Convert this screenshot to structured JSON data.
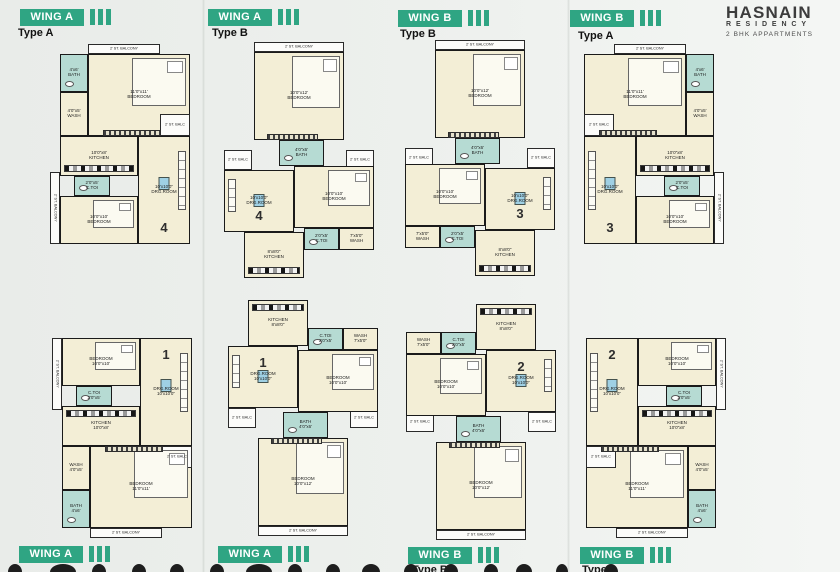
{
  "brand": {
    "name": "HASNAIN",
    "subname": "RESIDENCY",
    "tagline": "2 BHK  APPARTMENTS"
  },
  "colors": {
    "accent": "#2fa583",
    "room_cream": "#f3eed6",
    "wet_teal": "#b6dbd3",
    "wall": "#1a1a1a",
    "page_bg": "#edf0ed"
  },
  "headers_top": [
    {
      "wing": "WING A",
      "type_label": "Type A",
      "x": 20,
      "tx": 18,
      "y": 8,
      "ty": 27
    },
    {
      "wing": "WING A",
      "type_label": "Type B",
      "x": 208,
      "tx": 212,
      "y": 8,
      "ty": 27
    },
    {
      "wing": "WING B",
      "type_label": "Type B",
      "x": 398,
      "tx": 400,
      "y": 9,
      "ty": 28
    },
    {
      "wing": "WING B",
      "type_label": "Type A",
      "x": 570,
      "tx": 578,
      "y": 9,
      "ty": 30
    }
  ],
  "footers_bottom": [
    {
      "wing": "WING A",
      "x": 19,
      "y": 545
    },
    {
      "wing": "WING A",
      "x": 218,
      "y": 545
    },
    {
      "wing": "WING B",
      "x": 408,
      "y": 546
    },
    {
      "wing": "WING B",
      "x": 580,
      "y": 546
    }
  ],
  "bottom_partials": [
    {
      "label": "Type B",
      "x": 412,
      "y": 564
    },
    {
      "label": "Type A",
      "x": 582,
      "y": 564
    }
  ],
  "layouts": {
    "typeA": {
      "w": 140,
      "h": 200,
      "rooms": [
        {
          "id": "balcony-top",
          "kind": "balcony",
          "name": "2' ST. BALCONY",
          "x": 38,
          "y": 0,
          "w": 72,
          "h": 10
        },
        {
          "id": "bedroom-1",
          "kind": "room",
          "dims": "11'0\"x11'",
          "name": "BEDROOM",
          "x": 38,
          "y": 10,
          "w": 102,
          "h": 82,
          "furn": "bed",
          "wardrobe": true
        },
        {
          "id": "bath",
          "kind": "wet",
          "dims": "4'x6'",
          "name": "BATH",
          "x": 10,
          "y": 10,
          "w": 28,
          "h": 38,
          "furn": "wc"
        },
        {
          "id": "wash",
          "kind": "room",
          "dims": "4'0\"x5'",
          "name": "WASH",
          "x": 10,
          "y": 48,
          "w": 28,
          "h": 44
        },
        {
          "id": "balc-right",
          "kind": "balcony",
          "name": "2' ST. BALC",
          "x": 110,
          "y": 70,
          "w": 30,
          "h": 22
        },
        {
          "id": "kitchen",
          "kind": "room",
          "dims": "10'0\"x8'",
          "name": "KITCHEN",
          "x": 10,
          "y": 92,
          "w": 78,
          "h": 40,
          "furn": "counter"
        },
        {
          "id": "drg-room",
          "kind": "room",
          "dims": "10'x10'0\"",
          "name": "DRG.ROOM",
          "x": 88,
          "y": 92,
          "w": 52,
          "h": 108,
          "furn": "sofa",
          "sofa_side": "right",
          "number": true
        },
        {
          "id": "c-toi",
          "kind": "wet",
          "dims": "2'0\"x5'",
          "name": "C.TOI",
          "x": 24,
          "y": 132,
          "w": 36,
          "h": 20,
          "furn": "wc"
        },
        {
          "id": "balcony-left",
          "kind": "balcony",
          "name": "2' ST. BALCONY",
          "x": 0,
          "y": 128,
          "w": 10,
          "h": 72,
          "vertical": true
        },
        {
          "id": "bedroom-2",
          "kind": "room",
          "dims": "10'0\"x10'",
          "name": "BEDROOM",
          "x": 10,
          "y": 152,
          "w": 78,
          "h": 48,
          "furn": "bed"
        }
      ]
    },
    "typeB": {
      "w": 150,
      "h": 236,
      "rooms": [
        {
          "id": "balcony-top",
          "kind": "balcony",
          "name": "2' ST. BALCONY",
          "x": 30,
          "y": 0,
          "w": 90,
          "h": 10
        },
        {
          "id": "bedroom-1",
          "kind": "room",
          "dims": "10'0\"x12'",
          "name": "BEDROOM",
          "x": 30,
          "y": 10,
          "w": 90,
          "h": 88,
          "furn": "bed",
          "wardrobe": true
        },
        {
          "id": "bath",
          "kind": "wet",
          "dims": "4'0\"x6'",
          "name": "BATH",
          "x": 55,
          "y": 98,
          "w": 45,
          "h": 26,
          "furn": "wc"
        },
        {
          "id": "balc-left",
          "kind": "balcony",
          "name": "2' ST. BALC",
          "x": 0,
          "y": 108,
          "w": 28,
          "h": 20
        },
        {
          "id": "balc-right",
          "kind": "balcony",
          "name": "2' ST. BALC",
          "x": 122,
          "y": 108,
          "w": 28,
          "h": 20
        },
        {
          "id": "drg-room",
          "kind": "room",
          "dims": "10'x10'0\"",
          "name": "DRG.ROOM",
          "x": 0,
          "y": 128,
          "w": 70,
          "h": 62,
          "furn": "sofa",
          "sofa_side": "left",
          "number": true
        },
        {
          "id": "bedroom-2",
          "kind": "room",
          "dims": "10'0\"x10'",
          "name": "BEDROOM",
          "x": 70,
          "y": 124,
          "w": 80,
          "h": 62,
          "furn": "bed"
        },
        {
          "id": "c-toi",
          "kind": "wet",
          "dims": "2'0\"x5'",
          "name": "C.TOI",
          "x": 80,
          "y": 186,
          "w": 35,
          "h": 22,
          "furn": "wc"
        },
        {
          "id": "wash",
          "kind": "room",
          "dims": "7'x5'0\"",
          "name": "WASH",
          "x": 115,
          "y": 186,
          "w": 35,
          "h": 22
        },
        {
          "id": "kitchen",
          "kind": "room",
          "dims": "8'x8'0\"",
          "name": "KITCHEN",
          "x": 20,
          "y": 190,
          "w": 60,
          "h": 46,
          "furn": "counter"
        }
      ]
    }
  },
  "plans": [
    {
      "layout": "typeA",
      "wing": "WING A",
      "type": "Type A",
      "x": 50,
      "y": 44,
      "mx": false,
      "my": false,
      "number": "4"
    },
    {
      "layout": "typeB",
      "wing": "WING A",
      "type": "Type B",
      "x": 224,
      "y": 42,
      "mx": false,
      "my": false,
      "number": "4"
    },
    {
      "layout": "typeB",
      "wing": "WING B",
      "type": "Type B",
      "x": 405,
      "y": 40,
      "mx": true,
      "my": false,
      "number": "3"
    },
    {
      "layout": "typeA",
      "wing": "WING B",
      "type": "Type A",
      "x": 584,
      "y": 44,
      "mx": true,
      "my": false,
      "number": "3"
    },
    {
      "layout": "typeA",
      "wing": "WING A",
      "type": "Type A",
      "x": 52,
      "y": 338,
      "mx": false,
      "my": true,
      "number": "1"
    },
    {
      "layout": "typeB",
      "wing": "WING A",
      "type": "Type B",
      "x": 228,
      "y": 300,
      "mx": false,
      "my": true,
      "number": "1"
    },
    {
      "layout": "typeB",
      "wing": "WING B",
      "type": "Type B",
      "x": 406,
      "y": 304,
      "mx": true,
      "my": true,
      "number": "2"
    },
    {
      "layout": "typeA",
      "wing": "WING B",
      "type": "Type A",
      "x": 586,
      "y": 338,
      "mx": true,
      "my": true,
      "number": "2"
    }
  ]
}
